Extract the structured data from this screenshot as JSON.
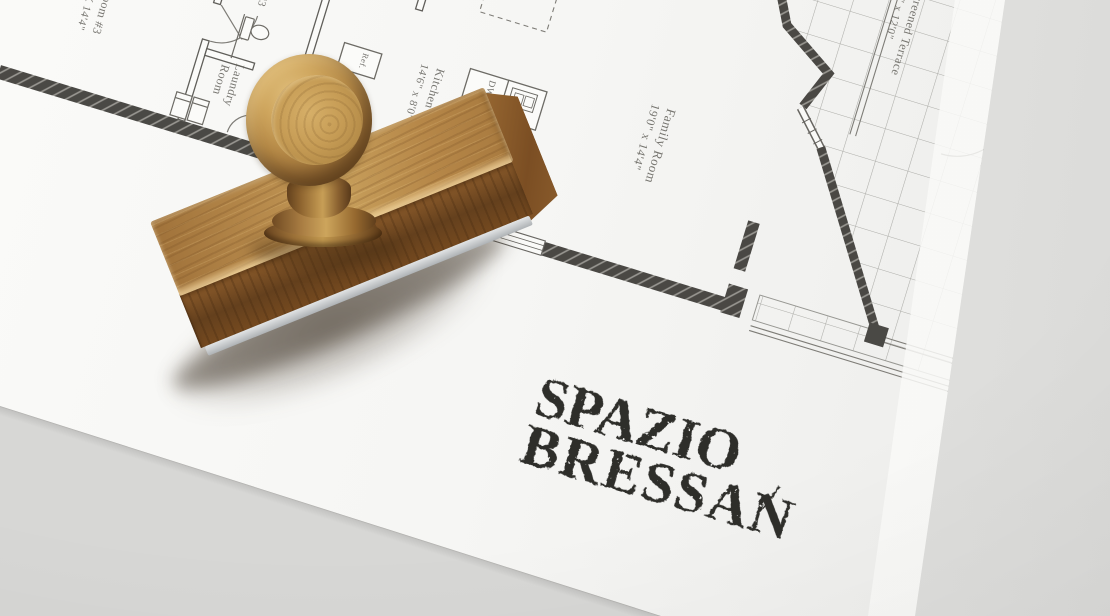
{
  "logo": {
    "line1": "SPAZIO",
    "separator": "/",
    "line2": "BRESSAN",
    "ink_color": "#2e2d2a"
  },
  "floor_plan": {
    "labels": {
      "bedroom3": {
        "line1": "Bedroom #3",
        "line2": "11'4\" X 14'4\""
      },
      "bath3": {
        "line1": "Bath #3"
      },
      "laundry": {
        "line1": "Laundry",
        "line2": "Room"
      },
      "kitchen": {
        "line1": "Kitchen",
        "line2": "14'6\" x 8'0\""
      },
      "family": {
        "line1": "Family Room",
        "line2": "19'0\" x 14'4\""
      },
      "terrace": {
        "line1": "Screened Terrace",
        "line2": "9'6\" x 12'0\""
      }
    },
    "fixtures": {
      "ref": "Ref.",
      "dw": "DW"
    },
    "ink_color": "#4c4a44",
    "wall_color": "#32302c"
  },
  "materials": {
    "paper": "#f6f6f4",
    "table_shadow": "#d2d2d0",
    "paper_fold": "#e6e6e4",
    "wood_highlight": "#e0bf7c",
    "wood_mid": "#a87c42",
    "wood_dark": "#64401d",
    "rubber": "#c5c8ca"
  }
}
